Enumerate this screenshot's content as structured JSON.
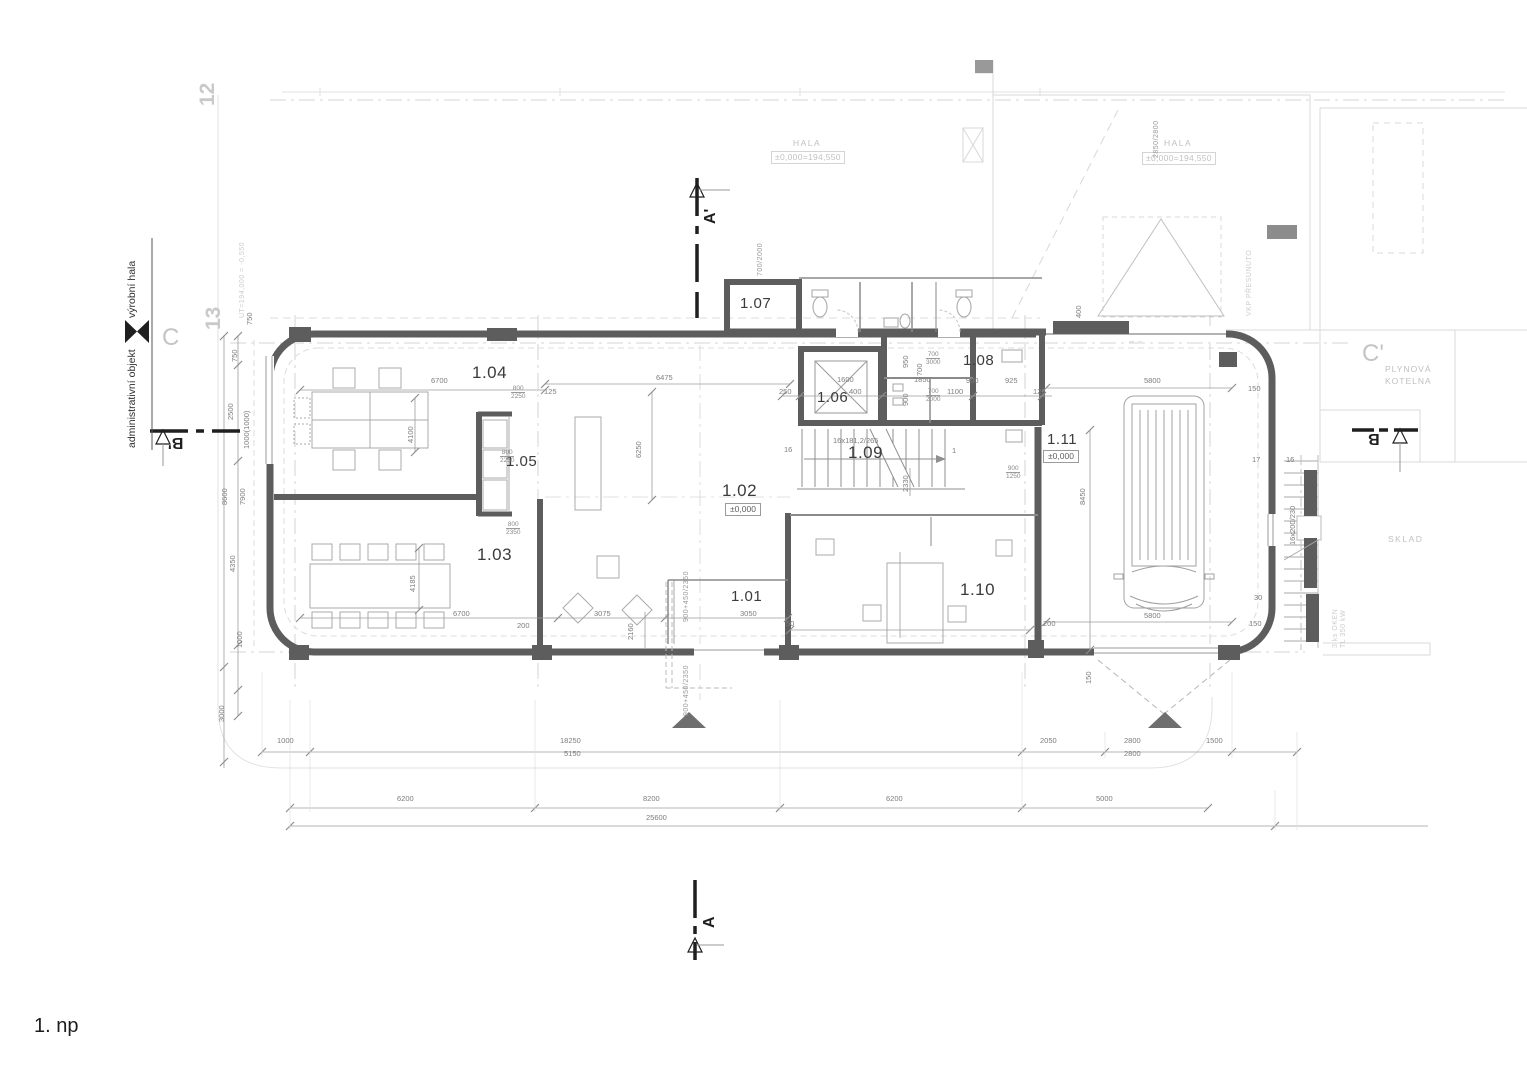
{
  "title": "1. np",
  "axes": {
    "n12": "12",
    "n13": "13",
    "c": "C",
    "c_prime": "C'"
  },
  "sections": {
    "a_top": "A'",
    "a_bottom": "A",
    "b_left": "B'",
    "b_right": "B"
  },
  "context": {
    "hala_left": "HALA",
    "hala_left_level": "±0,000=194,550",
    "hala_right": "HALA",
    "hala_right_level": "±0,000=194,550",
    "kotelna_line1": "PLYNOVÁ",
    "kotelna_line2": "KOTELNA",
    "sklad": "SKLAD",
    "vyrobni_hala": "výrobní hala",
    "admin_objekt": "administrativní objekt",
    "ut_level": "UT=194,000 = -0,550",
    "vkp_note": "VKP PŘESUNUTO",
    "okna_note1": "3 ks OKEN",
    "okna_note2": "TL 350 kW"
  },
  "rooms": [
    {
      "id": "1.01"
    },
    {
      "id": "1.02",
      "level": "±0,000"
    },
    {
      "id": "1.03"
    },
    {
      "id": "1.04"
    },
    {
      "id": "1.05"
    },
    {
      "id": "1.06"
    },
    {
      "id": "1.07"
    },
    {
      "id": "1.08"
    },
    {
      "id": "1.09"
    },
    {
      "id": "1.10"
    },
    {
      "id": "1.11",
      "level": "±0,000"
    }
  ],
  "stairs": {
    "internal_formula": "16x181,2/265",
    "internal_start": "16",
    "internal_end": "1",
    "external_formula": "16x200/230",
    "n17": "17",
    "n16": "16",
    "n30": "30",
    "n150a": "150",
    "n150b": "150"
  },
  "dims": {
    "b1": "1000",
    "b2": "18250",
    "b3": "5150",
    "b4": "2050",
    "b5": "2800",
    "b6": "2800",
    "b7": "1500",
    "c1": "6200",
    "c2": "8200",
    "c3": "6200",
    "c4": "5000",
    "t1": "25600",
    "l1": "750",
    "l2": "2500",
    "l3": "1000(1000)",
    "l4": "8600",
    "l5": "7900",
    "l6": "4350",
    "l7": "1000",
    "l8": "3000",
    "l9": "750",
    "r1": "8450",
    "r2": "400",
    "r3": "5800",
    "r4": "5800",
    "r7": "200",
    "r8": "50",
    "r9": "150",
    "m1": "6700",
    "m2": "4100",
    "m3": "125",
    "m4": "6700",
    "m5": "4185",
    "m6": "200",
    "m7": "6475",
    "m8": "6250",
    "m9": "3075",
    "m10": "2160",
    "m11": "3050",
    "m12": "2330",
    "m13": "250",
    "m14": "1600",
    "m15": "400",
    "m16": "1850",
    "m17": "900",
    "m18": "925",
    "m19": "1100",
    "m21": "125",
    "m22": "950",
    "m23": "900",
    "m24": "700",
    "f1": "700/2000",
    "f8": "900+450/2350",
    "f9": "900+450/2350",
    "f10": "2850/2800",
    "f2a": "700",
    "f2b": "3000",
    "f3a": "700",
    "f3b": "2000",
    "f4a": "800",
    "f4b": "2250",
    "f5a": "800",
    "f5b": "2250",
    "f6a": "800",
    "f6b": "2350",
    "f7a": "900",
    "f7b": "1250"
  },
  "colors": {
    "wall": "#5d5d5d",
    "dimension": "#8f8f8f",
    "context_faint": "#d6d6d6",
    "label": "#3b3b3b",
    "axis_gray": "#c6c6c6",
    "marker_black": "#1f1f1f"
  }
}
